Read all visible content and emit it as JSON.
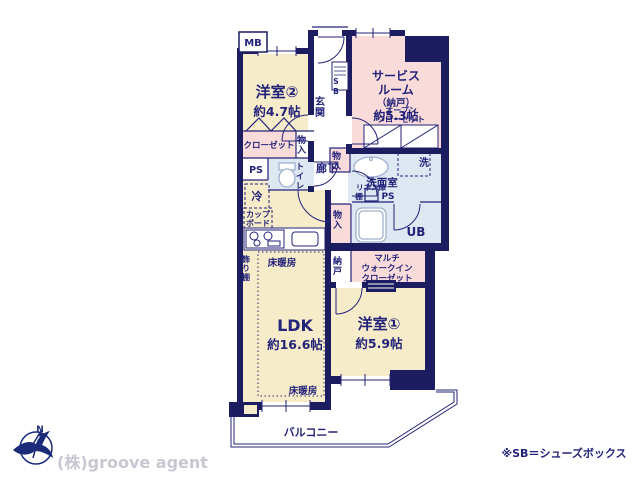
{
  "title": "apartment-floor-plan",
  "colors": {
    "wall": "#1c1c60",
    "room_cream": "#f7ecca",
    "room_pink": "#f9dcda",
    "room_blue": "#dde8f3",
    "text_navy": "#23237a",
    "fixture_stroke": "#9fb0ce",
    "company_gray": "#c7c7d2"
  },
  "labels": {
    "mb": "MB",
    "western2": "洋室②",
    "western2_size": "約4.7帖",
    "entrance": "玄関",
    "shoe_box": "SB",
    "service_1": "サービス",
    "service_2": "ルーム",
    "service_3": "（納戸）",
    "service_4": "約5.3帖",
    "open_closet_1": "オープン",
    "open_closet_2": "クローゼット",
    "hallway": "廊下",
    "closet": "クローゼット",
    "storage": "物入",
    "ps": "PS",
    "toilet": "トイレ",
    "fridge": "冷",
    "cupboard_1": "カップ",
    "cupboard_2": "ボード",
    "washer": "洗",
    "washroom": "洗面室",
    "linen": "リネン庫",
    "shelf": "棚",
    "ub": "UB",
    "nando": "納戸",
    "wic_1": "マルチ",
    "wic_2": "ウォークイン",
    "wic_3": "クローゼット",
    "display_shelf": "飾り棚",
    "floor_heating": "床暖房",
    "ldk": "LDK",
    "ldk_size": "約16.6帖",
    "western1": "洋室①",
    "western1_size": "約5.9帖",
    "balcony": "バルコニー"
  },
  "footer": {
    "company": "(株)groove agent",
    "note": "※SB＝シューズボックス"
  }
}
